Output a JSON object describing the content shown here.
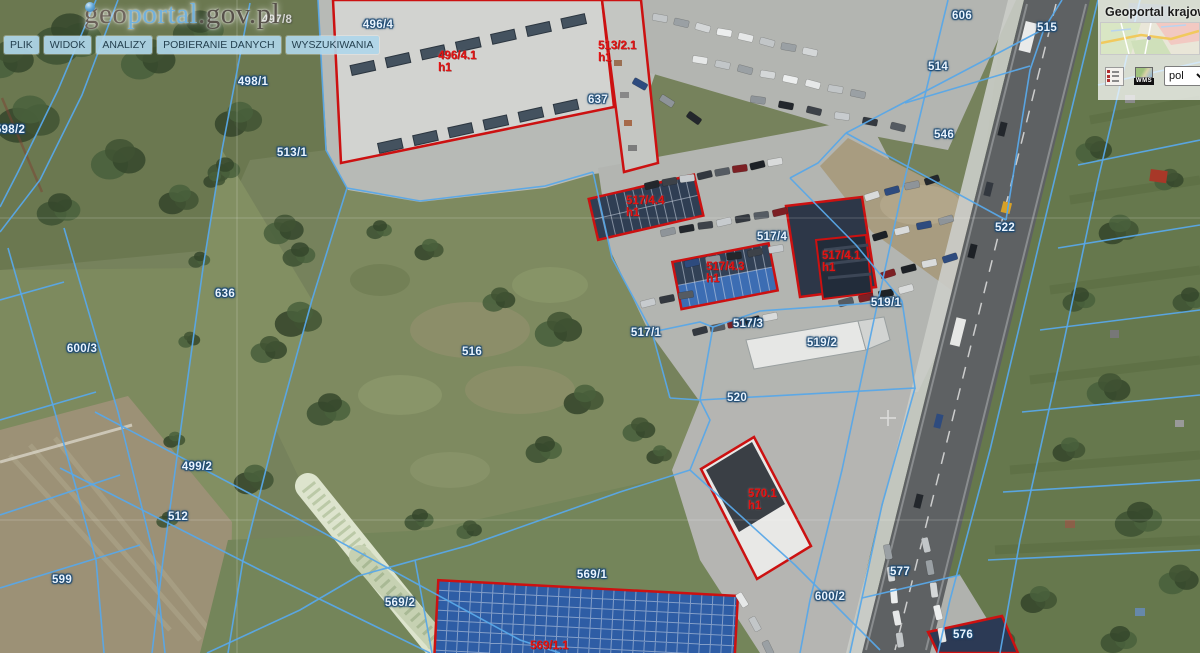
{
  "logo": {
    "prefix": "geo",
    "highlight": "portal",
    "suffix": ".gov.pl"
  },
  "menu": {
    "items": [
      {
        "id": "plik",
        "label": "PLIK"
      },
      {
        "id": "widok",
        "label": "WIDOK"
      },
      {
        "id": "analizy",
        "label": "ANALIZY"
      },
      {
        "id": "pobieranie-danych",
        "label": "POBIERANIE DANYCH"
      },
      {
        "id": "wyszukiwania",
        "label": "WYSZUKIWANIA"
      }
    ]
  },
  "right_panel": {
    "title": "Geoportal krajow",
    "language_value": "pol",
    "wms_label": "WMS",
    "icons": [
      "legend-icon",
      "wms-icon",
      "chevron-down-icon"
    ]
  },
  "map": {
    "colors": {
      "parcel_line": "#59a8e8",
      "building_outline": "#cc1111",
      "parcel_text": "#eaf4fe",
      "building_text": "#e31414"
    },
    "parcel_labels": [
      {
        "text": "598/2",
        "x": 10,
        "y": 130
      },
      {
        "text": "497/8",
        "x": 277,
        "y": 20,
        "faint": true
      },
      {
        "text": "498/1",
        "x": 253,
        "y": 82
      },
      {
        "text": "496/4",
        "x": 378,
        "y": 25
      },
      {
        "text": "513/1",
        "x": 292,
        "y": 153
      },
      {
        "text": "637",
        "x": 598,
        "y": 100
      },
      {
        "text": "606",
        "x": 962,
        "y": 16
      },
      {
        "text": "514",
        "x": 938,
        "y": 67
      },
      {
        "text": "515",
        "x": 1047,
        "y": 28
      },
      {
        "text": "546",
        "x": 944,
        "y": 135
      },
      {
        "text": "522",
        "x": 1005,
        "y": 228
      },
      {
        "text": "636",
        "x": 225,
        "y": 294
      },
      {
        "text": "600/3",
        "x": 82,
        "y": 349
      },
      {
        "text": "516",
        "x": 472,
        "y": 352
      },
      {
        "text": "517/1",
        "x": 646,
        "y": 333
      },
      {
        "text": "517/3",
        "x": 748,
        "y": 324
      },
      {
        "text": "517/4",
        "x": 772,
        "y": 237
      },
      {
        "text": "519/1",
        "x": 886,
        "y": 303
      },
      {
        "text": "519/2",
        "x": 822,
        "y": 343
      },
      {
        "text": "520",
        "x": 737,
        "y": 398
      },
      {
        "text": "499/2",
        "x": 197,
        "y": 467
      },
      {
        "text": "512",
        "x": 178,
        "y": 517
      },
      {
        "text": "599",
        "x": 62,
        "y": 580
      },
      {
        "text": "569/2",
        "x": 400,
        "y": 603
      },
      {
        "text": "569/1",
        "x": 592,
        "y": 575
      },
      {
        "text": "577",
        "x": 900,
        "y": 572
      },
      {
        "text": "600/2",
        "x": 830,
        "y": 597
      },
      {
        "text": "576",
        "x": 963,
        "y": 635
      }
    ],
    "building_labels": [
      {
        "text": "496/4.1",
        "sub": "h1",
        "x": 438,
        "y": 50
      },
      {
        "text": "513/2.1",
        "sub": "h1",
        "x": 598,
        "y": 40
      },
      {
        "text": "517/4.4",
        "sub": "h1",
        "x": 626,
        "y": 195
      },
      {
        "text": "517/4.3",
        "sub": "h1",
        "x": 706,
        "y": 261
      },
      {
        "text": "517/4.1",
        "sub": "h1",
        "x": 822,
        "y": 250
      },
      {
        "text": "570.1",
        "sub": "h1",
        "x": 748,
        "y": 488
      },
      {
        "text": "569/1.1",
        "sub": "",
        "x": 530,
        "y": 640
      }
    ],
    "boundaries": [
      "318,0 326,150 347,188 420,201 545,186 593,172",
      "593,172 612,258 652,332 670,398",
      "652,332 700,322 713,327",
      "713,327 760,311 902,301",
      "902,301 915,388 700,400 670,398",
      "700,400 713,327",
      "846,133 1044,29 1062,0",
      "846,133 818,163 790,178",
      "846,133 1006,220",
      "1006,220 1030,70 1044,29",
      "790,178 856,245 902,301",
      "905,103 1030,66",
      "948,0 905,178 875,315 842,470 810,600 800,653",
      "1098,0 1040,240 990,450 950,600 938,653",
      "1140,0 1098,180 1060,360 1020,540 1000,653",
      "1098,85 1200,62",
      "1078,165 1200,140",
      "1058,248 1200,225",
      "1040,330 1200,310",
      "1022,412 1200,395",
      "1003,492 1200,480",
      "988,560 1200,550",
      "250,3 222,150 203,268 182,420 163,560 152,653",
      "347,188 312,300 276,430 243,560 228,653",
      "118,0 82,95 40,180 0,232",
      "96,0 58,90 18,172 0,207",
      "64,228 118,412 155,560 165,653",
      "8,248 60,430 96,560 104,653",
      "0,300 64,282",
      "0,420 96,392",
      "0,515 120,475",
      "0,588 140,545",
      "95,412 300,520 520,640 560,653",
      "60,468 260,570 430,653",
      "207,653 300,610 358,576",
      "358,576 470,545 620,492 690,470",
      "415,560 432,653",
      "690,470 710,420 700,400",
      "690,470 795,565 880,650",
      "915,388 882,505 862,598 850,653",
      "862,598 960,575"
    ]
  }
}
